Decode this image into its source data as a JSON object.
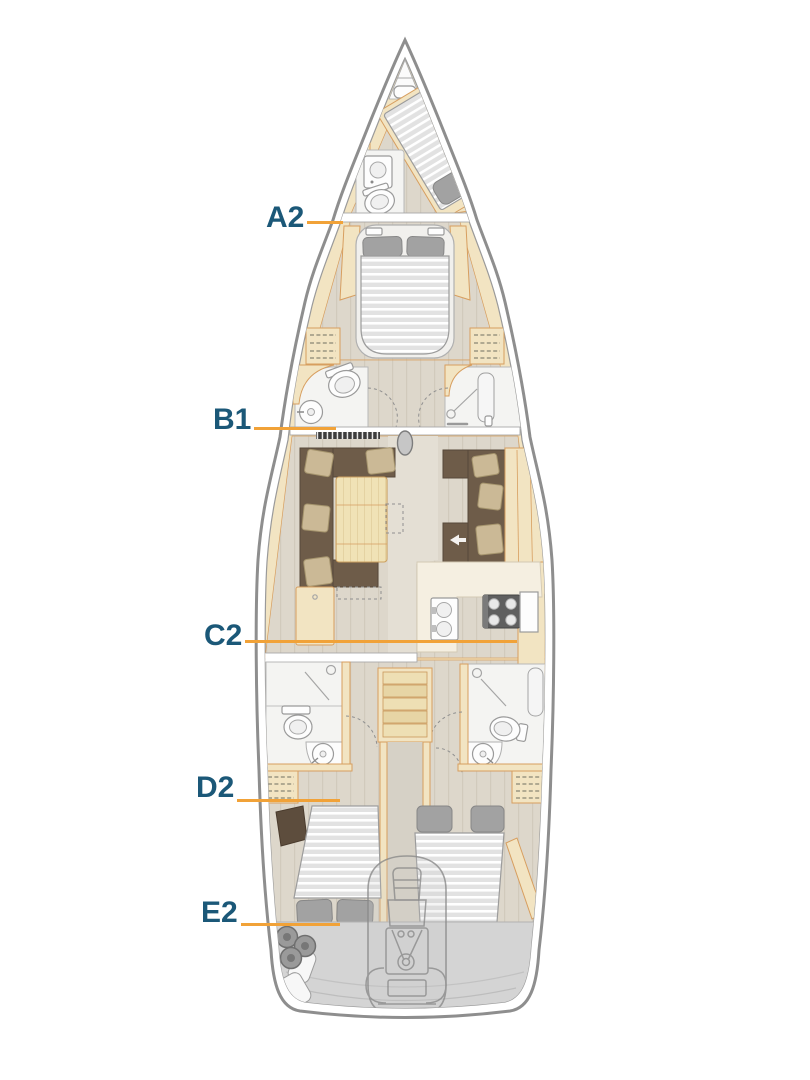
{
  "labels": [
    {
      "text": "A2"
    },
    {
      "text": "B1"
    },
    {
      "text": "C2"
    },
    {
      "text": "D2"
    },
    {
      "text": "E2"
    }
  ],
  "colors": {
    "label_text": "#1B5878",
    "leader_line": "#F1A238",
    "hull_line": "#8E8E8E",
    "wood": "#F2E4C2",
    "wood_trim": "#D79E5F",
    "floor": "#DDD7CB",
    "sofa": "#6E5C49",
    "pillow": "#CBB996",
    "deck": "#D4D4D4",
    "bathroom": "#F4F4F2"
  }
}
